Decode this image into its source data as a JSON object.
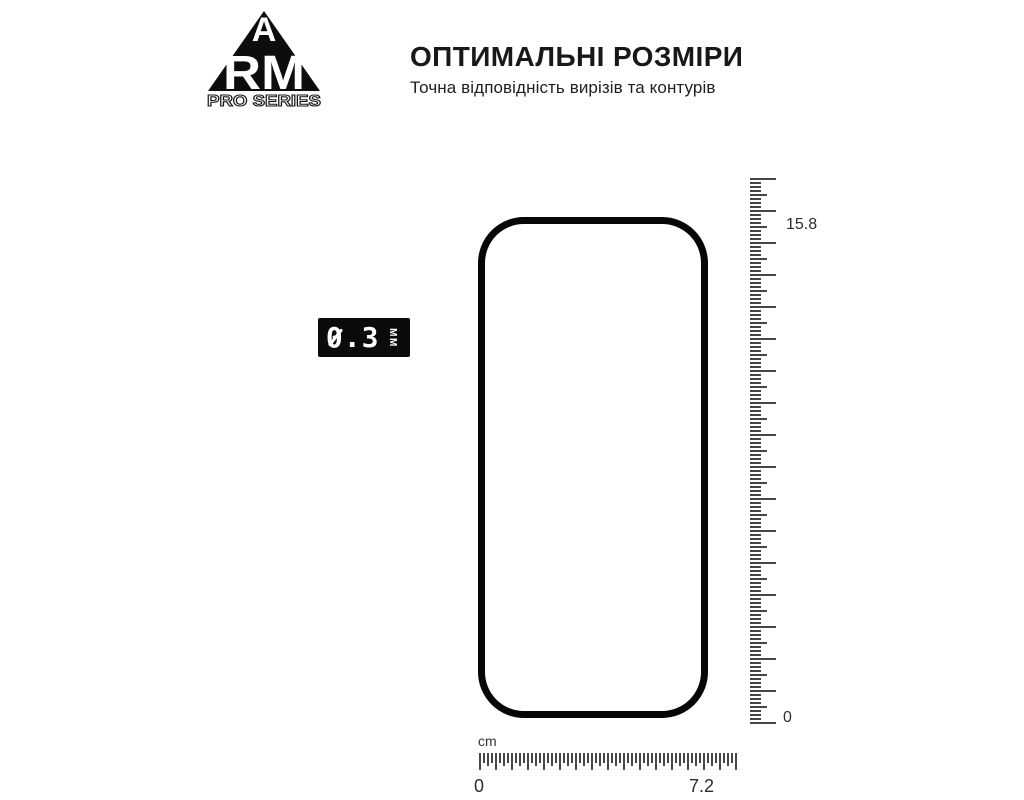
{
  "brand": {
    "letter_top": "A",
    "letters_main": "RM",
    "series_label": "PRO SERIES"
  },
  "header": {
    "title": "ОПТИМАЛЬНІ РОЗМІРИ",
    "subtitle": "Точна відповідність вирізів та контурів"
  },
  "thickness_badge": {
    "value": "0.3",
    "unit": "MM"
  },
  "diagram": {
    "vertical_ruler": {
      "top_label": "15.8",
      "bottom_label": "0"
    },
    "horizontal_ruler": {
      "unit": "cm",
      "start_label": "0",
      "end_label": "7.2"
    }
  },
  "colors": {
    "ink": "#111111",
    "tick": "#464646",
    "background": "#ffffff"
  }
}
